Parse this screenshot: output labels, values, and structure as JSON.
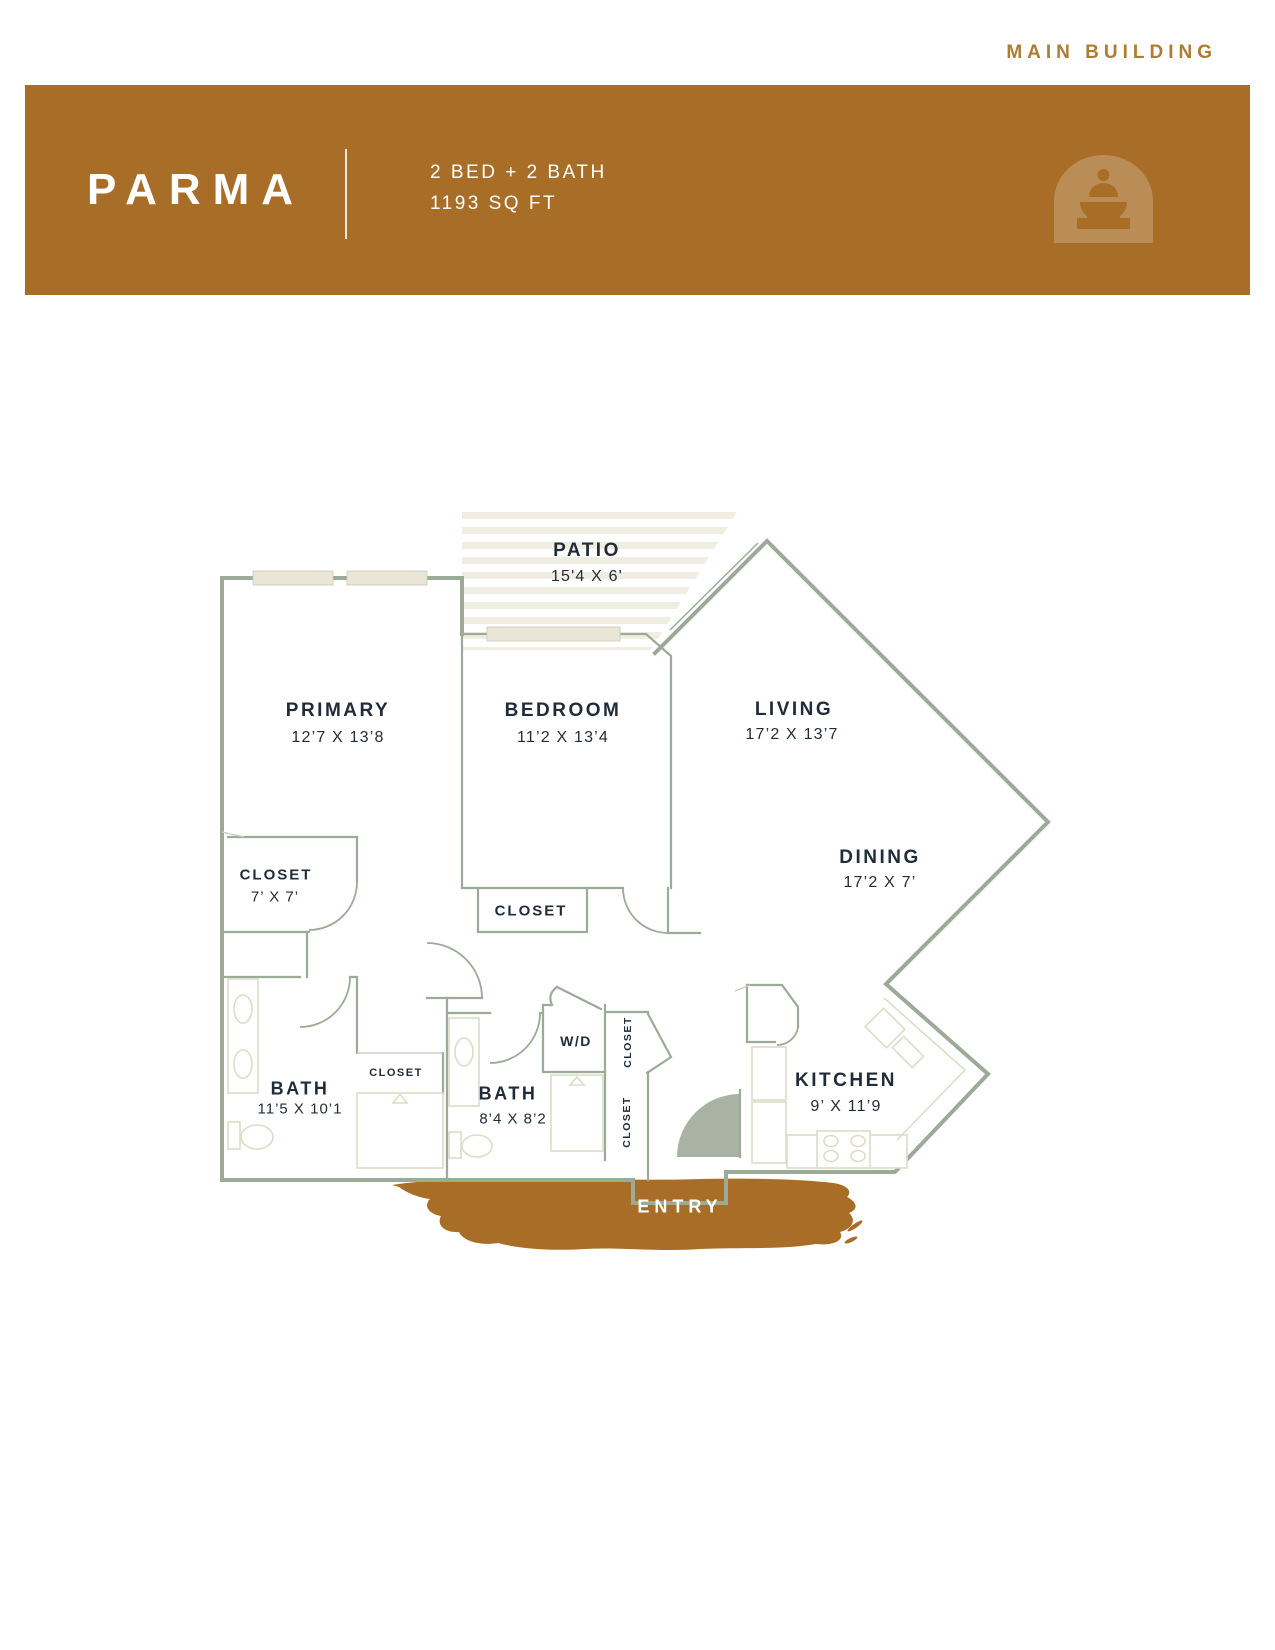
{
  "header": {
    "building_label": "MAIN BUILDING"
  },
  "banner": {
    "title": "PARMA",
    "spec_line1": "2 BED + 2 BATH",
    "spec_line2": "1193 SQ FT",
    "icon": "fountain-arch-icon",
    "colors": {
      "banner_bg": "#A86E27",
      "accent_text": "#AE7C33",
      "title_text": "#FFFFFF"
    }
  },
  "floor_plan": {
    "rooms": {
      "patio": {
        "name": "PATIO",
        "dims": "15'4 X 6'"
      },
      "primary": {
        "name": "PRIMARY",
        "dims": "12’7 X 13’8"
      },
      "bedroom": {
        "name": "BEDROOM",
        "dims": "11’2 X 13’4"
      },
      "living": {
        "name": "LIVING",
        "dims": "17’2 X 13’7"
      },
      "dining": {
        "name": "DINING",
        "dims": "17’2 X 7’"
      },
      "primary_closet": {
        "name": "CLOSET",
        "dims": "7’ X 7’"
      },
      "bedroom_closet": {
        "name": "CLOSET"
      },
      "bath_primary": {
        "name": "BATH",
        "dims": "11’5 X 10’1"
      },
      "hall_closet": {
        "name": "CLOSET"
      },
      "bath2": {
        "name": "BATH",
        "dims": "8’4 X 8’2"
      },
      "laundry": {
        "name": "W/D"
      },
      "utility_closet_upper": {
        "name": "CLOSET"
      },
      "utility_closet_lower": {
        "name": "CLOSET"
      },
      "kitchen": {
        "name": "KITCHEN",
        "dims": "9’ X 11’9"
      },
      "entry": {
        "name": "ENTRY"
      }
    },
    "colors": {
      "wall": "#9CAA98",
      "fixture": "#DEDBC7",
      "window_fill": "#E9E6D7",
      "patio_stripe": "#F0EEE3",
      "label_text": "#202C39",
      "door_swing_fill": "#A8B3A4",
      "entry_brush": "#A86E27"
    }
  }
}
